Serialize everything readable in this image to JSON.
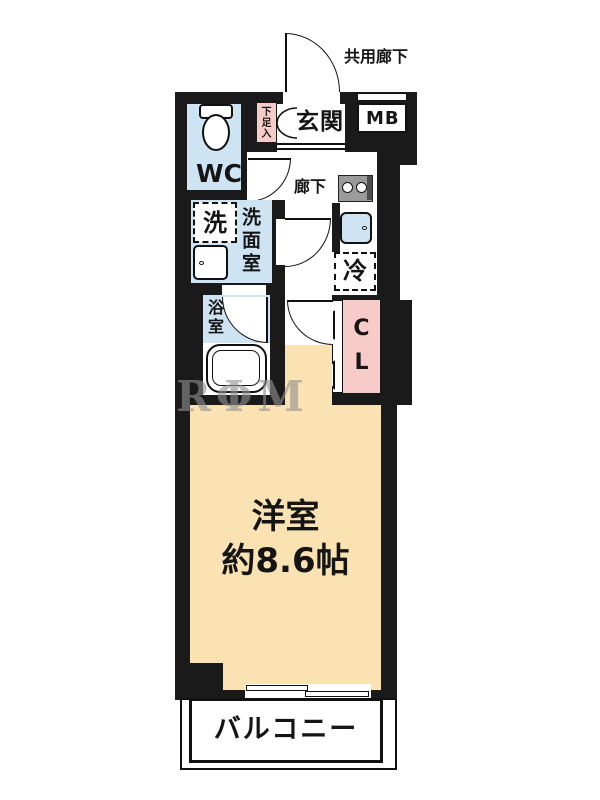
{
  "plan": {
    "labels": {
      "common_corridor": "共用廊下",
      "entrance": "玄関",
      "meter_box": "MB",
      "shoe_box": "下足入",
      "toilet": "WC",
      "hallway": "廊下",
      "washer": "洗",
      "washroom": "洗面室",
      "bathroom": "浴室",
      "fridge": "冷",
      "closet": "CL",
      "room_name": "洋室",
      "room_size": "約8.6帖",
      "balcony": "バルコニー"
    },
    "watermark": "RΦM CORP",
    "colors": {
      "wall": "#1a1a1a",
      "wet_area_blue": "#cfe4f2",
      "storage_pink": "#f7cbc7",
      "room_peach": "#fbe2b2"
    }
  }
}
